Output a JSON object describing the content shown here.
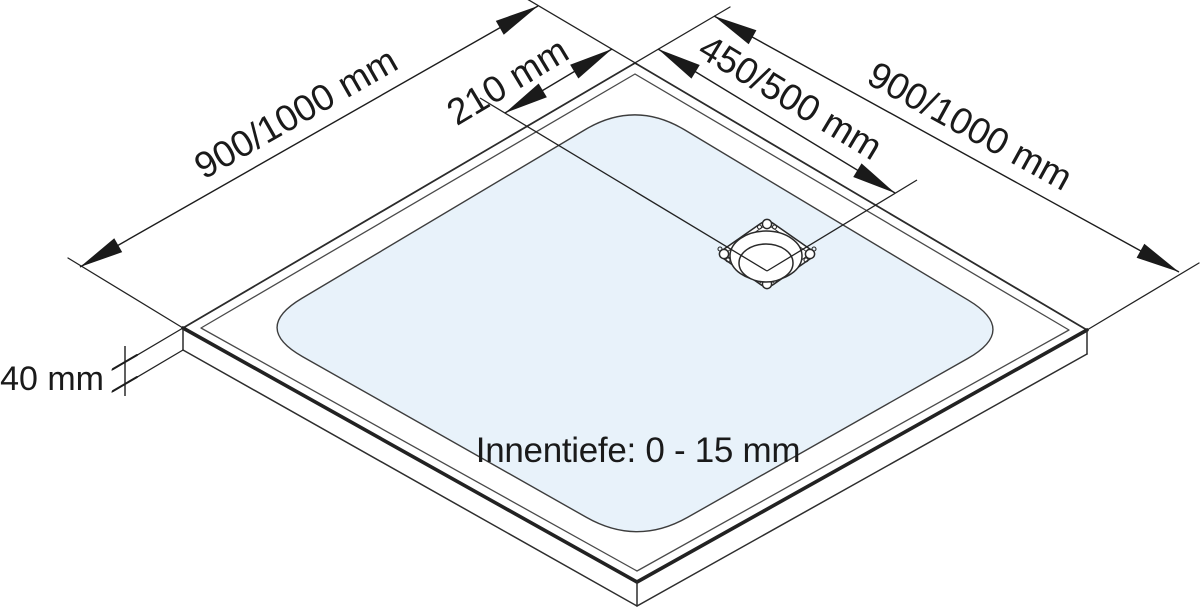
{
  "figure": {
    "background": "#ffffff",
    "line_color": "#2a2a2a",
    "text_color": "#1a1a1a",
    "basin_fill": "#e8f2fa"
  },
  "labels": {
    "edge_left": "900/1000 mm",
    "drain_offset": "210 mm",
    "drain_span": "450/500 mm",
    "edge_right": "900/1000 mm",
    "tray_height": "40 mm",
    "inner_depth": "Innentiefe: 0 - 15 mm"
  }
}
